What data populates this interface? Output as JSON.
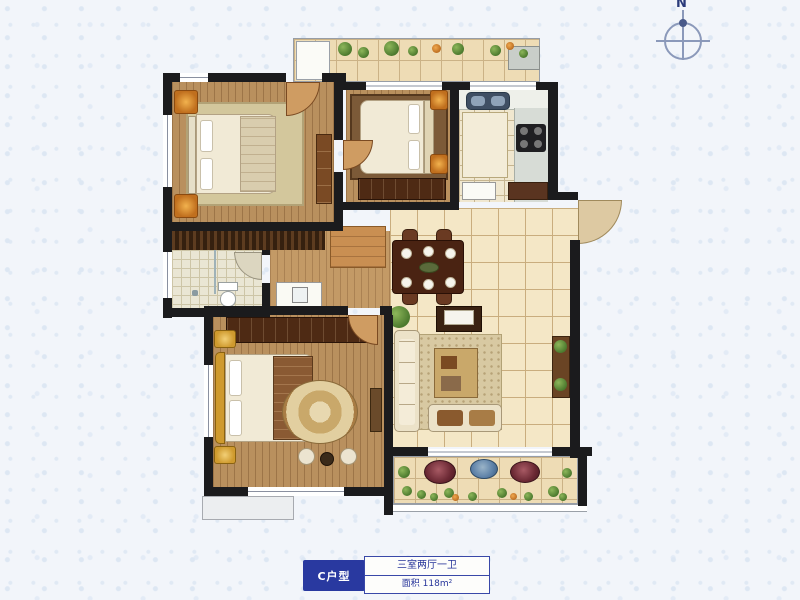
{
  "compass": {
    "north_label": "N"
  },
  "label_card": {
    "unit": "C户型",
    "layout_text": "三室两厅一卫",
    "area_text": "面积 118m²"
  },
  "colors": {
    "background": "#f2f5fa",
    "wall": "#1b1b1d",
    "accent_blue": "#2939a0",
    "wood_floor": "#b9905e",
    "tile_floor": "#f4e7c6",
    "plant_green": "#5d8f3c",
    "pot_red": "#7a2f3a",
    "pot_blue": "#5b7fa6",
    "nightstand_orange": "#c06f1e",
    "gold": "#cf9a2e"
  },
  "rooms": [
    "north-balcony",
    "bedroom-1",
    "bedroom-2",
    "kitchen",
    "entry-foyer",
    "dining-area",
    "living-room",
    "hallway",
    "bathroom",
    "master-bedroom",
    "south-balcony",
    "ac-platform"
  ],
  "furniture_icons": [
    "double-bed",
    "nightstand",
    "wardrobe",
    "closet",
    "dining-table",
    "dining-chair",
    "tv-cabinet",
    "sofa",
    "loveseat",
    "coffee-table",
    "round-rug",
    "leisure-chair",
    "tea-table",
    "toilet",
    "washbasin",
    "kitchen-sink",
    "stove",
    "fridge",
    "kitchen-island",
    "washer",
    "plant",
    "flower-pot",
    "door-swing",
    "window",
    "sliding-door",
    "compass-rose"
  ]
}
